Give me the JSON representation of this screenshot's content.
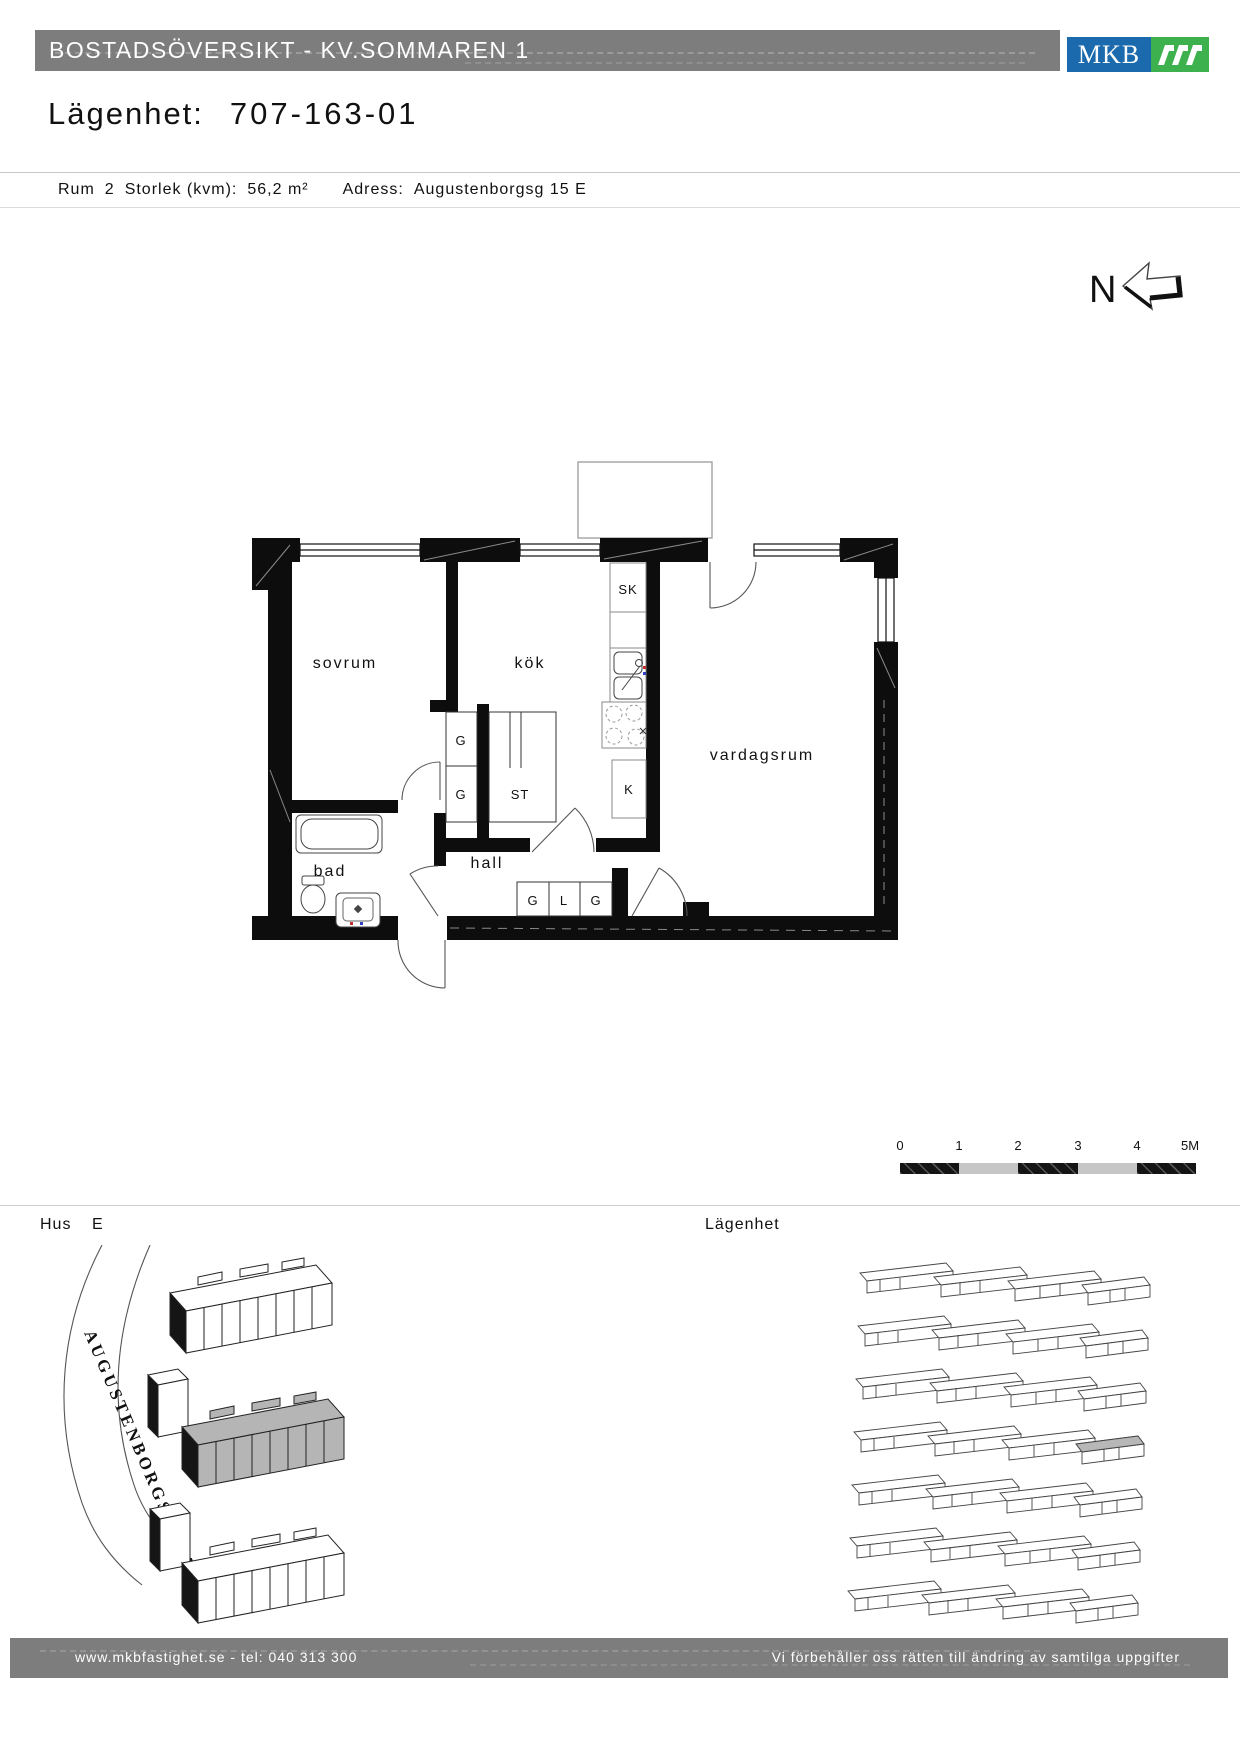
{
  "header": {
    "title": "BOSTADSÖVERSIKT - KV.SOMMAREN 1"
  },
  "logo": {
    "text": "MKB",
    "blue": "#1a6aad",
    "green": "#3cb14d"
  },
  "apartment": {
    "label": "Lägenhet:",
    "number": "707-163-01"
  },
  "info": {
    "rooms_label": "Rum",
    "rooms_value": "2",
    "size_label": "Storlek (kvm):",
    "size_value": "56,2 m²",
    "address_label": "Adress:",
    "address_value": "Augustenborgsg 15 E"
  },
  "compass": {
    "north_label": "N"
  },
  "floorplan": {
    "rooms": {
      "bedroom": "sovrum",
      "kitchen": "kök",
      "living_room": "vardagsrum",
      "bathroom": "bad",
      "hallway": "hall"
    },
    "closets": {
      "sk": "SK",
      "g1": "G",
      "g2": "G",
      "st": "ST",
      "k": "K",
      "hall_g1": "G",
      "hall_l": "L",
      "hall_g2": "G"
    }
  },
  "scalebar": {
    "ticks": [
      "0",
      "1",
      "2",
      "3",
      "4",
      "5M"
    ]
  },
  "site": {
    "house_label": "Hus",
    "house_value": "E",
    "apartment_label": "Lägenhet",
    "street_name": "AUGUSTENBORGSGATAN"
  },
  "footer": {
    "left": "www.mkbfastighet.se - tel: 040 313 300",
    "right": "Vi förbehåller oss rätten till ändring av samtilga uppgifter"
  }
}
